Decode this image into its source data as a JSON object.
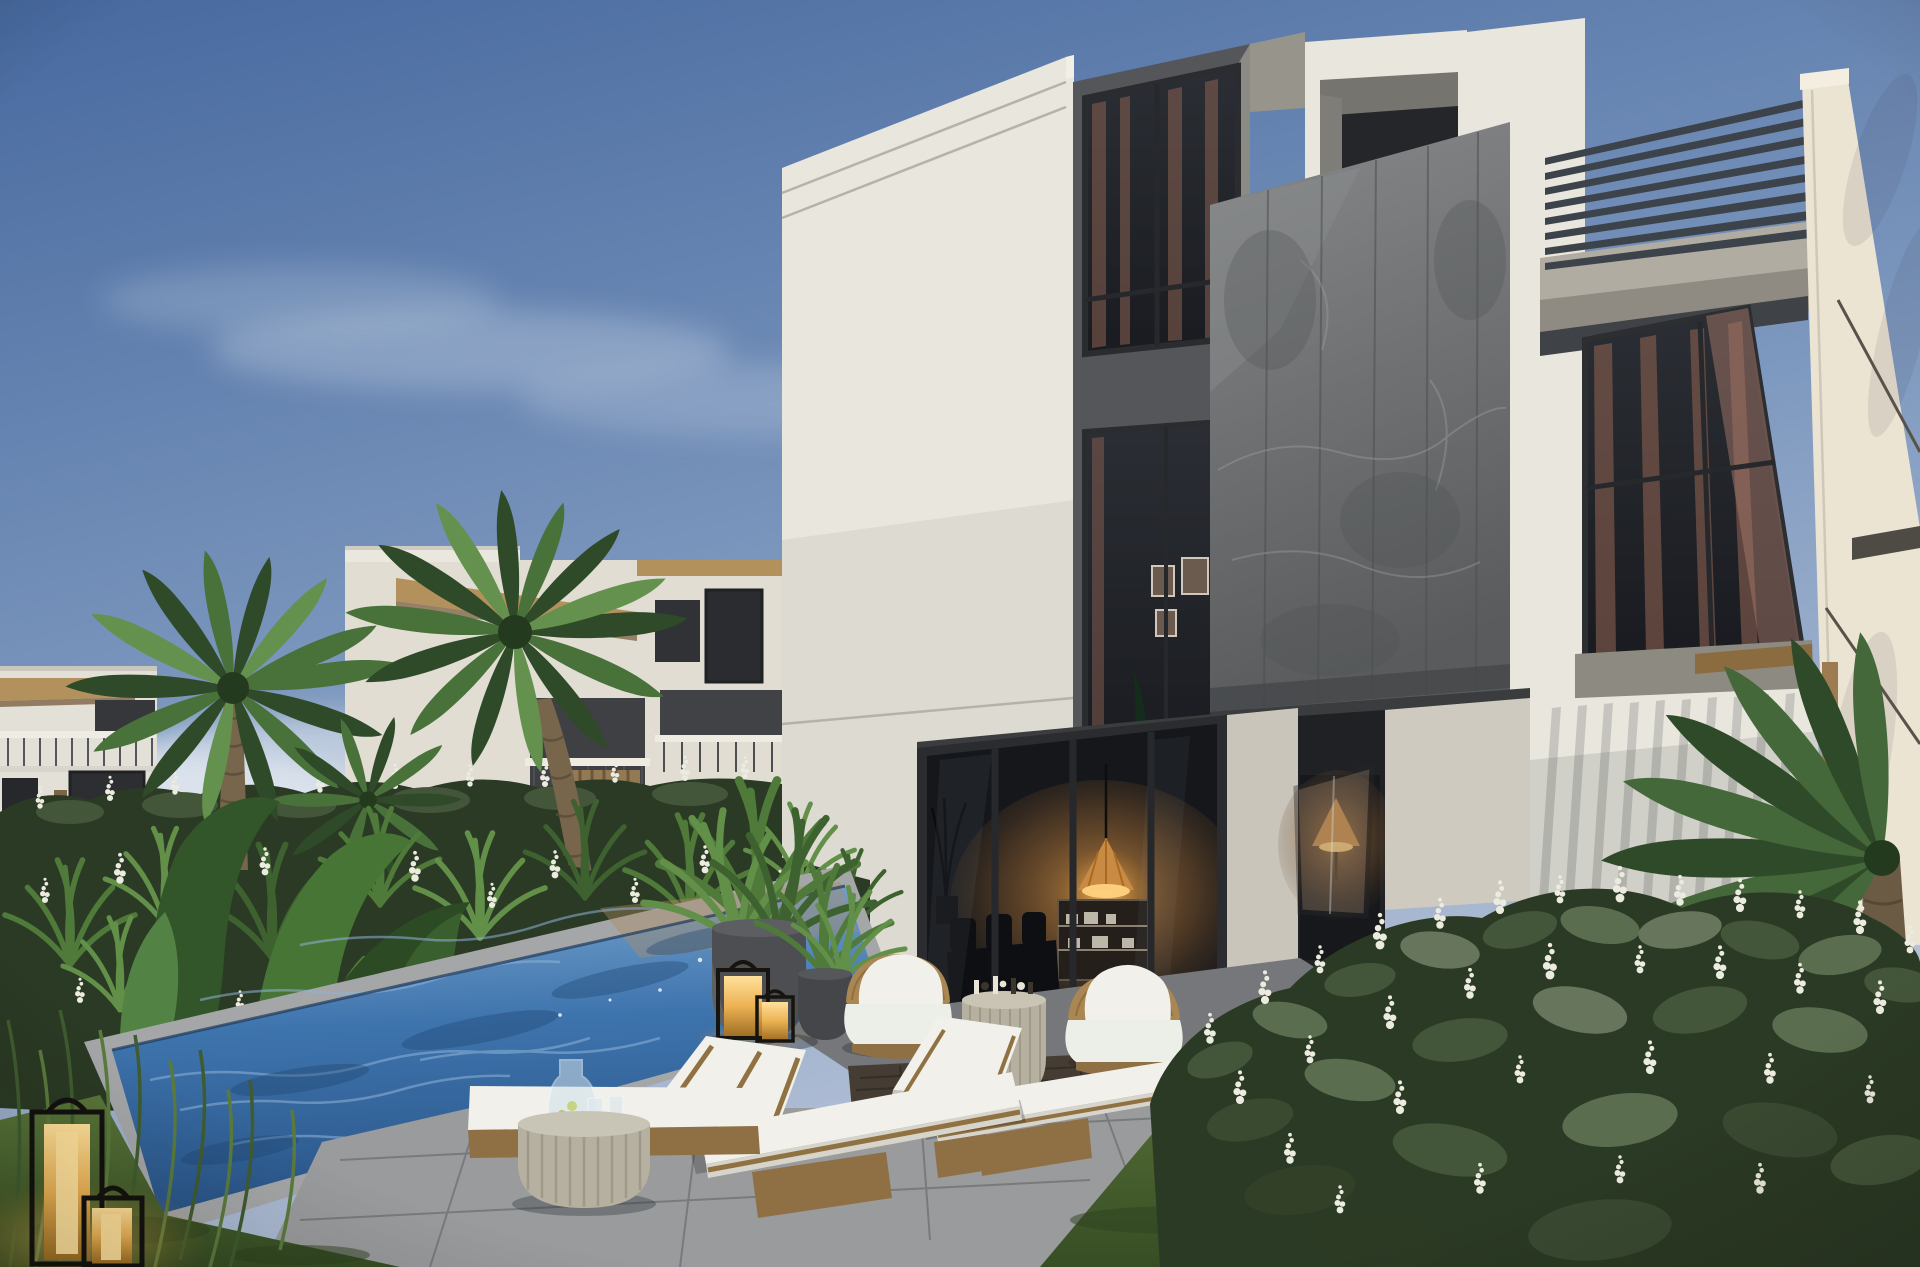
{
  "scene": {
    "title": "3D architectural rendering: modern three-storey white villa with grey stone feature panel, rooftop pergola, plunge pool, sun loungers and lush tropical garden at golden hour",
    "type": "exterior-render",
    "objects": [
      {
        "name": "sky",
        "description": "clear blue sky with thin white clouds"
      },
      {
        "name": "background-townhouses",
        "description": "white townhouses with thatch roof overhangs, balconies and slatted screens"
      },
      {
        "name": "date-palms",
        "description": "two large date palms on the left, one palm at right edge"
      },
      {
        "name": "villa",
        "description": "three-storey white villa with dark window bays"
      },
      {
        "name": "stone-feature-panel",
        "description": "large grey marble-textured floating panel"
      },
      {
        "name": "pergola",
        "description": "dark metal roof slats attached to white blade wall"
      },
      {
        "name": "curtained-windows",
        "description": "floor-to-ceiling glazing with warm curtains"
      },
      {
        "name": "sliding-glass-doors",
        "description": "ground floor glazing with lit interior, rattan pendant lamp and shelving"
      },
      {
        "name": "open-casement-window",
        "description": "open pane with warm lamp glow"
      },
      {
        "name": "plunge-pool",
        "description": "rippled blue pool with stone coping"
      },
      {
        "name": "pool-daybed",
        "description": "white cushioned platform with carafe and two glasses"
      },
      {
        "name": "sun-loungers",
        "description": "two white and bronze chaise lounges"
      },
      {
        "name": "drum-side-tables",
        "description": "ribbed round concrete tables"
      },
      {
        "name": "rattan-armchairs",
        "description": "two round rattan chairs with white cushions and pillows"
      },
      {
        "name": "decor-side-table",
        "description": "small ribbed table with decorative pieces"
      },
      {
        "name": "planters",
        "description": "dark grey cylinder planters with areca palms"
      },
      {
        "name": "brass-lanterns",
        "description": "four glowing brass and black floor lanterns"
      },
      {
        "name": "flower-hedge",
        "description": "shrubs with white flower spikes"
      },
      {
        "name": "lawn",
        "description": "green grass areas"
      },
      {
        "name": "timber-deck",
        "description": "dark wood deck strip with moss joint"
      },
      {
        "name": "stone-patio",
        "description": "grey paved terrace and garden path"
      }
    ]
  },
  "palette": {
    "sky_top": "#47699f",
    "sky_mid": "#7e99bf",
    "sky_low": "#b7c3d7",
    "cloud": "#e3e9f0",
    "wall_lit": "#e9e6dd",
    "wall_shade": "#c2bfb6",
    "wall_warm": "#ece4d2",
    "dark_band": "#55565a",
    "frame_dark": "#2a2c2f",
    "glass_mid": "#2b2e34",
    "glass_dark": "#191b20",
    "curtain_warm": "#8a6051",
    "stone_light": "#868889",
    "stone_dark": "#595b5d",
    "soffit": "#3a3c3e",
    "slat": "#3d434b",
    "thatch": "#b3915d",
    "trunk": "#77654c",
    "palm_dark": "#2f4a28",
    "palm_mid": "#49713a",
    "palm_light": "#65914e",
    "hedge_dark": "#2b3a24",
    "hedge_mid": "#44563a",
    "leaf_grey": "#66755c",
    "flower_white": "#ecebdf",
    "pool_light": "#7fa9d2",
    "pool_mid": "#3e74ad",
    "pool_deep": "#2a5588",
    "grass_lit": "#5a7639",
    "grass_dark": "#374d24",
    "paver_lit": "#9a9b9d",
    "paver_shade": "#75777a",
    "paver_joint": "#67696c",
    "curb": "#d8d2c4",
    "deckwood": "#453c33",
    "moss": "#99a23f",
    "cushion": "#f1f0ea",
    "wood": "#8f6f44",
    "rattan": "#aa8752",
    "lantern_glow": "#f5c76d",
    "interior_warm": "#c98a43",
    "planter": "#4c4e51",
    "drum": "#b6b0a0"
  }
}
